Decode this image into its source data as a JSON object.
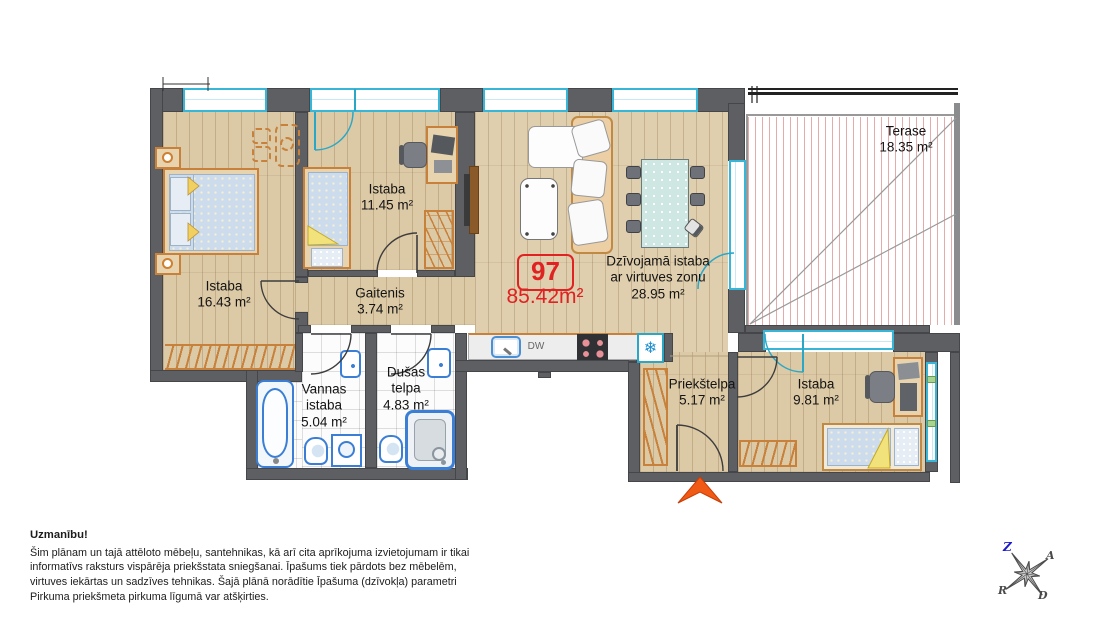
{
  "apartment": {
    "number": "97",
    "area": "85.42m²"
  },
  "rooms": [
    {
      "name": "Istaba",
      "area": "16.43 m²"
    },
    {
      "name": "Istaba",
      "area": "11.45 m²"
    },
    {
      "name": "Gaitenis",
      "area": "3.74 m²"
    },
    {
      "name": "Dzīvojamā istaba",
      "name2": "ar virtuves zonu",
      "area": "28.95 m²"
    },
    {
      "name": "Terase",
      "area": "18.35 m²"
    },
    {
      "name": "Vannas",
      "name2": "istaba",
      "area": "5.04 m²"
    },
    {
      "name": "Dušas",
      "name2": "telpa",
      "area": "4.83 m²"
    },
    {
      "name": "Priekštelpa",
      "area": "5.17 m²"
    },
    {
      "name": "Istaba",
      "area": "9.81 m²"
    }
  ],
  "kitchen": {
    "dishwasher": "DW",
    "freezer_icon": "❄"
  },
  "compass": {
    "n": "Z",
    "e": "A",
    "s": "D",
    "w": "R"
  },
  "note": {
    "title": "Uzmanību!",
    "body": "Šim plānam un tajā attēloto mēbeļu, santehnikas, kā arī cita aprīkojuma izvietojumam ir tikai informatīvs raksturs vispārēja priekšstata sniegšanai. Īpašums tiek pārdots bez mēbelēm, virtuves iekārtas un sadzīves tehnikas. Šajā plānā norādītie Īpašuma (dzīvokļa) parametri Pirkuma priekšmeta pirkuma līgumā var atšķirties."
  }
}
